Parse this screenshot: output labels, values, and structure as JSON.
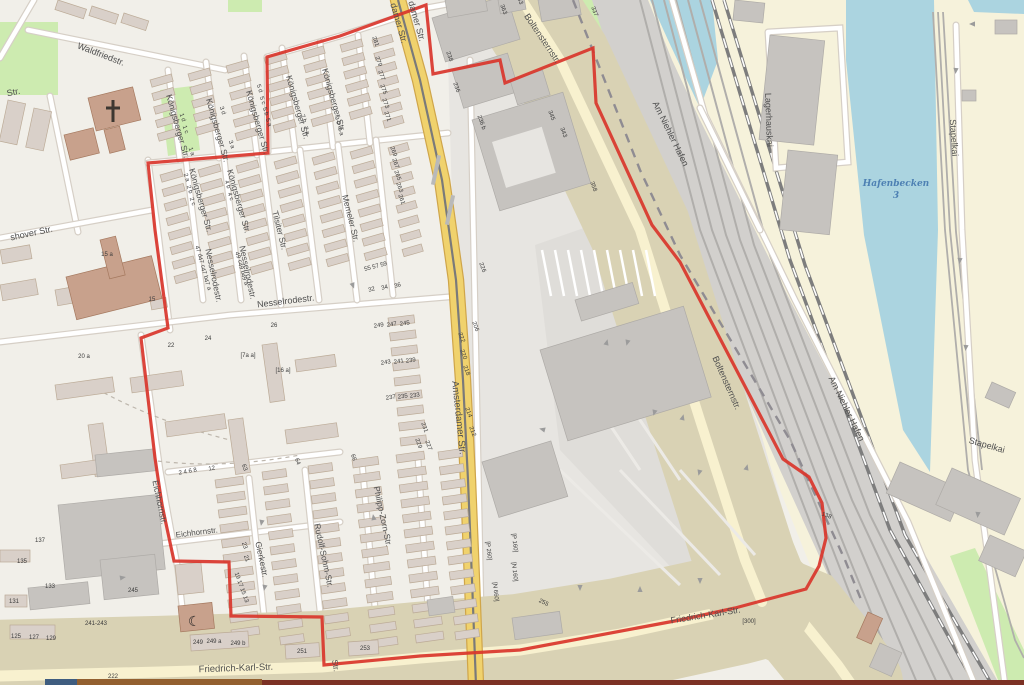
{
  "map": {
    "type": "openstreetmap-style city map with boundary overlay",
    "colors": {
      "land": "#f1efe9",
      "harbor_land": "#f6f2db",
      "water": "#abd4e0",
      "grass": "#cdebb0",
      "building": "#d9d0c9",
      "building_outline": "#bcab97",
      "industrial_building": "#c6c3bf",
      "industrial_building_outline": "#aeaba7",
      "worship_building": "#c8a18c",
      "worship_outline": "#a5795f",
      "industrial_area": "#e7e5e1",
      "parking_area": "#dfddd9",
      "road_major": "#f0d26d",
      "road_major_casing": "#cfa54a",
      "road_light": "#f8f1cf",
      "road_light_casing": "#d9d2b4",
      "road_minor": "#ffffff",
      "road_minor_casing": "#d6cfc6",
      "rail_area": "#d2d0cd",
      "rail_line": "#b0aeab",
      "rail_main": "#7d7d7d",
      "admin_dash": "#8f8c92",
      "boundary_red": "#d9352b",
      "tram_line": "#7a7a7a",
      "arrow": "#9b9b9b",
      "label": "#4f4f4f",
      "water_label": "#4d80b3",
      "bar_blue": "#3f5d80",
      "bar_brown": "#93602f",
      "bar_maroon": "#7c3124"
    },
    "boundary": {
      "stroke_width": 3.2,
      "points": "426,5 433,74 500,60 505,83 593,48 596,103 652,225 680,262 783,459 809,477 822,503 826,538 819,566 806,589 735,608 680,620 520,650 420,656 324,665 322,617 231,616 229,562 174,561 162,505 155,458 141,338 168,328 155,230 148,163 268,153 267,57 340,36 426,5"
    },
    "street_labels": [
      {
        "text": "damer Str.",
        "x": 396,
        "y": 24,
        "rot": 74,
        "size": 9
      },
      {
        "text": "damer Str.",
        "x": 414,
        "y": 22,
        "rot": 74,
        "size": 9
      },
      {
        "text": "Amsterdamer Str.",
        "x": 456,
        "y": 418,
        "rot": 84,
        "size": 9.5
      },
      {
        "text": "Boltensternstr.",
        "x": 540,
        "y": 40,
        "rot": 56,
        "size": 9
      },
      {
        "text": "Boltensternstr.",
        "x": 724,
        "y": 384,
        "rot": 66,
        "size": 9
      },
      {
        "text": "Am Niehler Hafen",
        "x": 668,
        "y": 135,
        "rot": 64,
        "size": 9
      },
      {
        "text": "Am Niehler Hafen",
        "x": 844,
        "y": 410,
        "rot": 64,
        "size": 9
      },
      {
        "text": "Lagerhauskai",
        "x": 766,
        "y": 120,
        "rot": 88,
        "size": 9
      },
      {
        "text": "Stapelkai",
        "x": 951,
        "y": 138,
        "rot": 86,
        "size": 9
      },
      {
        "text": "Stapelkai",
        "x": 986,
        "y": 448,
        "rot": 16,
        "size": 9
      },
      {
        "text": "Waldfriedstr.",
        "x": 100,
        "y": 57,
        "rot": 21,
        "size": 9
      },
      {
        "text": "Str.",
        "x": 14,
        "y": 95,
        "rot": -12,
        "size": 9
      },
      {
        "text": "shover Str.",
        "x": 32,
        "y": 236,
        "rot": -12,
        "size": 9
      },
      {
        "text": "Königsberger Str.",
        "x": 175,
        "y": 127,
        "rot": 74,
        "size": 8.5
      },
      {
        "text": "Königsberger Str.",
        "x": 215,
        "y": 131,
        "rot": 74,
        "size": 8.5
      },
      {
        "text": "Königsberger Str.",
        "x": 255,
        "y": 123,
        "rot": 74,
        "size": 8.5
      },
      {
        "text": "Königsberger Str.",
        "x": 295,
        "y": 108,
        "rot": 74,
        "size": 8.5
      },
      {
        "text": "Königsberger Str.",
        "x": 331,
        "y": 101,
        "rot": 74,
        "size": 8.5
      },
      {
        "text": "Königsberger Str.",
        "x": 198,
        "y": 201,
        "rot": 74,
        "size": 8.5
      },
      {
        "text": "Königsberger Str.",
        "x": 236,
        "y": 202,
        "rot": 74,
        "size": 8.5
      },
      {
        "text": "Tilsiter Str.",
        "x": 277,
        "y": 231,
        "rot": 76,
        "size": 8.5
      },
      {
        "text": "Memeler Str.",
        "x": 348,
        "y": 219,
        "rot": 76,
        "size": 8.5
      },
      {
        "text": "Nesselrodestr.",
        "x": 211,
        "y": 276,
        "rot": 78,
        "size": 8.5
      },
      {
        "text": "Nesselrodestr.",
        "x": 245,
        "y": 273,
        "rot": 78,
        "size": 8.5
      },
      {
        "text": "Nesselrodestr.",
        "x": 286,
        "y": 304,
        "rot": -7,
        "size": 9
      },
      {
        "text": "Eichhornstr.",
        "x": 157,
        "y": 503,
        "rot": 78,
        "size": 8.5
      },
      {
        "text": "Eichhornstr.",
        "x": 197,
        "y": 535,
        "rot": -7,
        "size": 8
      },
      {
        "text": "Gierkestr.",
        "x": 259,
        "y": 560,
        "rot": 78,
        "size": 8.5
      },
      {
        "text": "Rudolf-Sohm-Str.",
        "x": 321,
        "y": 556,
        "rot": 78,
        "size": 8.5
      },
      {
        "text": "Philipp-Zorn-Str.",
        "x": 380,
        "y": 517,
        "rot": 78,
        "size": 8.5
      },
      {
        "text": "Friedrich-Karl-Str.",
        "x": 236,
        "y": 671,
        "rot": -2,
        "size": 9.5
      },
      {
        "text": "Friedrich-Karl-Str.",
        "x": 706,
        "y": 618,
        "rot": -9,
        "size": 9
      },
      {
        "text": "Str.",
        "x": 333,
        "y": 666,
        "rot": 80,
        "size": 8
      }
    ],
    "water_labels": [
      {
        "text": "Hafenbecken",
        "x": 896,
        "y": 186,
        "size": 9
      },
      {
        "text": "3",
        "x": 896,
        "y": 198,
        "size": 9
      }
    ],
    "house_numbers": [
      {
        "text": "281",
        "x": 374,
        "y": 42,
        "rot": 70
      },
      {
        "text": "279",
        "x": 377,
        "y": 62,
        "rot": 70
      },
      {
        "text": "277",
        "x": 380,
        "y": 76,
        "rot": 70
      },
      {
        "text": "275",
        "x": 382,
        "y": 90,
        "rot": 70
      },
      {
        "text": "273",
        "x": 384,
        "y": 104,
        "rot": 70
      },
      {
        "text": "271",
        "x": 386,
        "y": 117,
        "rot": 70
      },
      {
        "text": "269",
        "x": 392,
        "y": 152,
        "rot": 70
      },
      {
        "text": "267",
        "x": 394,
        "y": 164,
        "rot": 70
      },
      {
        "text": "265",
        "x": 396,
        "y": 176,
        "rot": 70
      },
      {
        "text": "263",
        "x": 398,
        "y": 188,
        "rot": 70
      },
      {
        "text": "261",
        "x": 400,
        "y": 200,
        "rot": 70
      },
      {
        "text": "55 57 59",
        "x": 376,
        "y": 268,
        "rot": -15
      },
      {
        "text": "32",
        "x": 372,
        "y": 291,
        "rot": -15
      },
      {
        "text": "34",
        "x": 385,
        "y": 289,
        "rot": -15
      },
      {
        "text": "36",
        "x": 398,
        "y": 287,
        "rot": -15
      },
      {
        "text": "249",
        "x": 379,
        "y": 327,
        "rot": -8
      },
      {
        "text": "247",
        "x": 392,
        "y": 326,
        "rot": -8
      },
      {
        "text": "245",
        "x": 405,
        "y": 325,
        "rot": -8
      },
      {
        "text": "243",
        "x": 386,
        "y": 364,
        "rot": -8
      },
      {
        "text": "241",
        "x": 399,
        "y": 363,
        "rot": -8
      },
      {
        "text": "239",
        "x": 411,
        "y": 362,
        "rot": -8
      },
      {
        "text": "237",
        "x": 391,
        "y": 399,
        "rot": -8
      },
      {
        "text": "235",
        "x": 403,
        "y": 398,
        "rot": -8
      },
      {
        "text": "233",
        "x": 415,
        "y": 397,
        "rot": -8
      },
      {
        "text": "231",
        "x": 423,
        "y": 428,
        "rot": 70
      },
      {
        "text": "229",
        "x": 417,
        "y": 444,
        "rot": 70
      },
      {
        "text": "227",
        "x": 427,
        "y": 446,
        "rot": 70
      },
      {
        "text": "238",
        "x": 448,
        "y": 57,
        "rot": 70
      },
      {
        "text": "236",
        "x": 455,
        "y": 88,
        "rot": 70
      },
      {
        "text": "236 b",
        "x": 480,
        "y": 123,
        "rot": 70
      },
      {
        "text": "226",
        "x": 481,
        "y": 268,
        "rot": 70
      },
      {
        "text": "222",
        "x": 460,
        "y": 338,
        "rot": 70
      },
      {
        "text": "220",
        "x": 462,
        "y": 355,
        "rot": 70
      },
      {
        "text": "218",
        "x": 465,
        "y": 371,
        "rot": 70
      },
      {
        "text": "214",
        "x": 467,
        "y": 413,
        "rot": 70
      },
      {
        "text": "212",
        "x": 471,
        "y": 432,
        "rot": 70
      },
      {
        "text": "206",
        "x": 474,
        "y": 327,
        "rot": 70
      },
      {
        "text": "363",
        "x": 502,
        "y": 10,
        "rot": 70
      },
      {
        "text": "345",
        "x": 550,
        "y": 116,
        "rot": 70
      },
      {
        "text": "343",
        "x": 562,
        "y": 133,
        "rot": 70
      },
      {
        "text": "358",
        "x": 592,
        "y": 187,
        "rot": 70
      },
      {
        "text": "337",
        "x": 593,
        "y": 12,
        "rot": 70
      },
      {
        "text": "255",
        "x": 543,
        "y": 604,
        "rot": 25
      },
      {
        "text": "253",
        "x": 365,
        "y": 650,
        "rot": 0
      },
      {
        "text": "251",
        "x": 302,
        "y": 653,
        "rot": 0
      },
      {
        "text": "249",
        "x": 198,
        "y": 644,
        "rot": 0
      },
      {
        "text": "249 a",
        "x": 214,
        "y": 643,
        "rot": 0
      },
      {
        "text": "249 b",
        "x": 238,
        "y": 645,
        "rot": 0
      },
      {
        "text": "241-243",
        "x": 96,
        "y": 625,
        "rot": 0
      },
      {
        "text": "245",
        "x": 133,
        "y": 592,
        "rot": 0
      },
      {
        "text": "[300]",
        "x": 749,
        "y": 623,
        "rot": 0
      },
      {
        "text": "138",
        "x": 826,
        "y": 517,
        "rot": 20
      },
      {
        "text": "125",
        "x": 16,
        "y": 638,
        "rot": 0
      },
      {
        "text": "127",
        "x": 34,
        "y": 639,
        "rot": 0
      },
      {
        "text": "129",
        "x": 51,
        "y": 640,
        "rot": 0
      },
      {
        "text": "131",
        "x": 14,
        "y": 603,
        "rot": 0
      },
      {
        "text": "133",
        "x": 50,
        "y": 588,
        "rot": 0
      },
      {
        "text": "135",
        "x": 22,
        "y": 563,
        "rot": 0
      },
      {
        "text": "137",
        "x": 40,
        "y": 542,
        "rot": 0
      },
      {
        "text": "[P 260]",
        "x": 487,
        "y": 551,
        "rot": 84
      },
      {
        "text": "[P 160]",
        "x": 513,
        "y": 543,
        "rot": 84
      },
      {
        "text": "[N 160]",
        "x": 513,
        "y": 572,
        "rot": 84
      },
      {
        "text": "[N 660]",
        "x": 494,
        "y": 592,
        "rot": 84
      },
      {
        "text": "2 4 6 8",
        "x": 188,
        "y": 473,
        "rot": -10
      },
      {
        "text": "12",
        "x": 212,
        "y": 470,
        "rot": -10
      },
      {
        "text": "47 d",
        "x": 197,
        "y": 252,
        "rot": 70
      },
      {
        "text": "47 c",
        "x": 200,
        "y": 263,
        "rot": 70
      },
      {
        "text": "47 b",
        "x": 203,
        "y": 274,
        "rot": 70
      },
      {
        "text": "47 a",
        "x": 206,
        "y": 285,
        "rot": 70
      },
      {
        "text": "49 c",
        "x": 237,
        "y": 258,
        "rot": 70
      },
      {
        "text": "49 b",
        "x": 240,
        "y": 269,
        "rot": 70
      },
      {
        "text": "49 a",
        "x": 243,
        "y": 280,
        "rot": 70
      },
      {
        "text": "5 d",
        "x": 258,
        "y": 89,
        "rot": 70
      },
      {
        "text": "5 c",
        "x": 261,
        "y": 101,
        "rot": 70
      },
      {
        "text": "5 b",
        "x": 264,
        "y": 112,
        "rot": 70
      },
      {
        "text": "5 a",
        "x": 267,
        "y": 123,
        "rot": 70
      },
      {
        "text": "3 d",
        "x": 221,
        "y": 111,
        "rot": 70
      },
      {
        "text": "3 a",
        "x": 230,
        "y": 145,
        "rot": 70
      },
      {
        "text": "1 d",
        "x": 181,
        "y": 118,
        "rot": 70
      },
      {
        "text": "1 c",
        "x": 184,
        "y": 130,
        "rot": 70
      },
      {
        "text": "1 a",
        "x": 190,
        "y": 152,
        "rot": 70
      },
      {
        "text": "7 b",
        "x": 302,
        "y": 119,
        "rot": 70
      },
      {
        "text": "7 a",
        "x": 305,
        "y": 131,
        "rot": 70
      },
      {
        "text": "9 b",
        "x": 336,
        "y": 121,
        "rot": 70
      },
      {
        "text": "9 a",
        "x": 339,
        "y": 132,
        "rot": 70
      },
      {
        "text": "2 a",
        "x": 185,
        "y": 178,
        "rot": 70
      },
      {
        "text": "2 b",
        "x": 188,
        "y": 190,
        "rot": 70
      },
      {
        "text": "2 c",
        "x": 191,
        "y": 202,
        "rot": 70
      },
      {
        "text": "4 b",
        "x": 226,
        "y": 185,
        "rot": 70
      },
      {
        "text": "4 c",
        "x": 229,
        "y": 197,
        "rot": 70
      },
      {
        "text": "15 a",
        "x": 107,
        "y": 256,
        "rot": 0
      },
      {
        "text": "15",
        "x": 152,
        "y": 301,
        "rot": 0
      },
      {
        "text": "20 a",
        "x": 84,
        "y": 358,
        "rot": 0
      },
      {
        "text": "22",
        "x": 171,
        "y": 347,
        "rot": 0
      },
      {
        "text": "24",
        "x": 208,
        "y": 340,
        "rot": 0
      },
      {
        "text": "26",
        "x": 274,
        "y": 327,
        "rot": 0
      },
      {
        "text": "[16 a]",
        "x": 283,
        "y": 372,
        "rot": 0
      },
      {
        "text": "[7a a]",
        "x": 248,
        "y": 357,
        "rot": 0
      },
      {
        "text": "222",
        "x": 113,
        "y": 678,
        "rot": 0
      },
      {
        "text": "23",
        "x": 243,
        "y": 546,
        "rot": 70
      },
      {
        "text": "21",
        "x": 245,
        "y": 559,
        "rot": 70
      },
      {
        "text": "19 17 15 13",
        "x": 240,
        "y": 588,
        "rot": 70
      },
      {
        "text": "63",
        "x": 243,
        "y": 468,
        "rot": 70
      },
      {
        "text": "64",
        "x": 296,
        "y": 462,
        "rot": 70
      },
      {
        "text": "66",
        "x": 352,
        "y": 458,
        "rot": 70
      },
      {
        "text": "253",
        "x": 518,
        "y": 0,
        "rot": 70
      }
    ]
  }
}
